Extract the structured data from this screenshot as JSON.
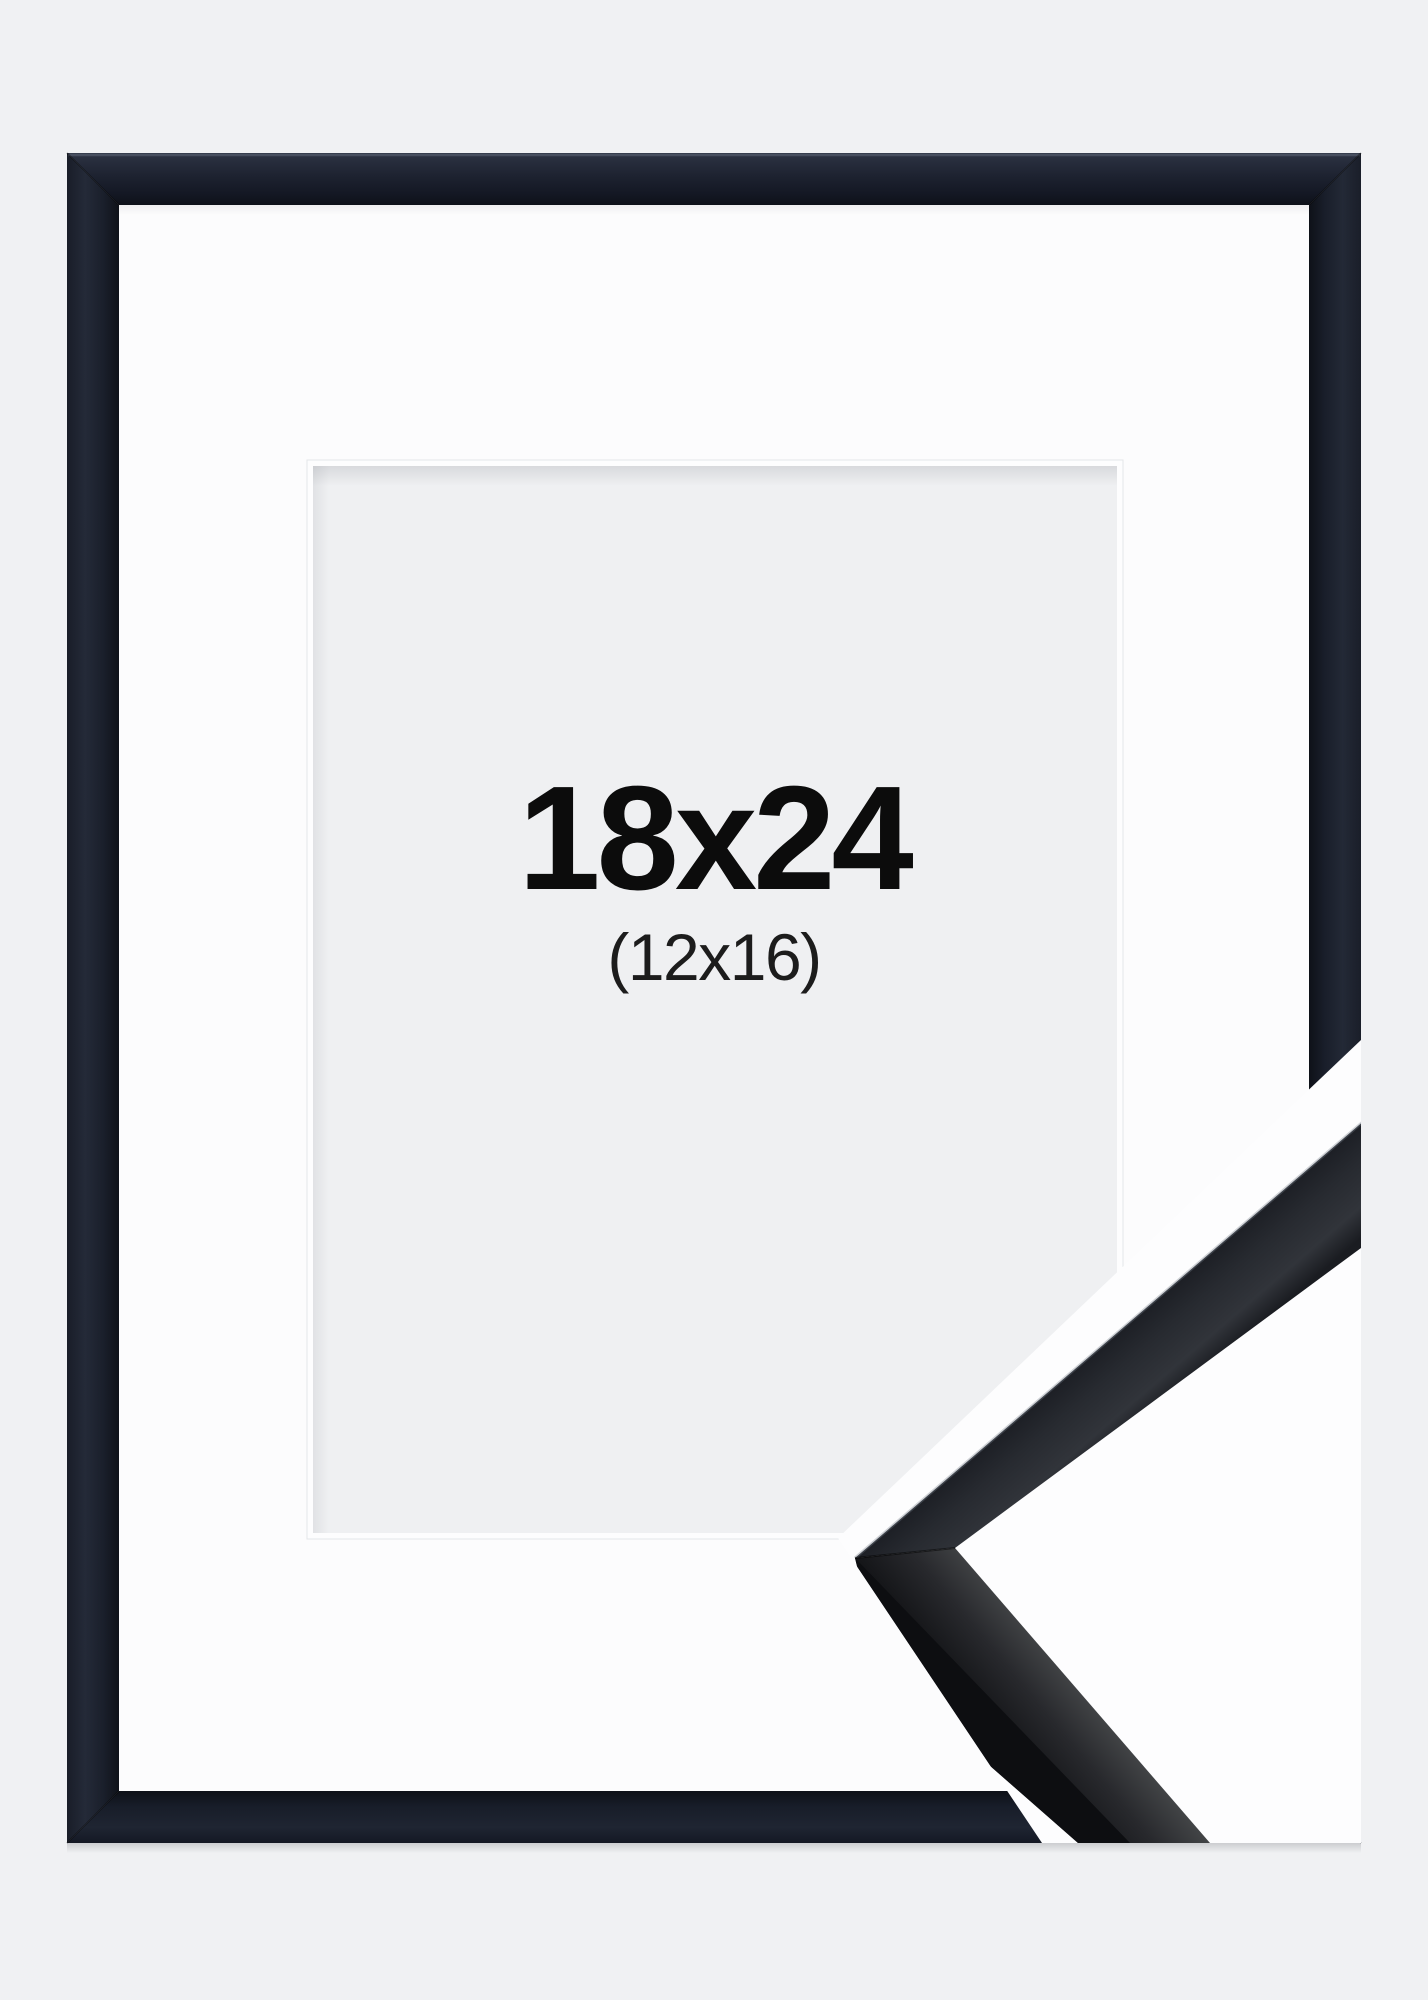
{
  "product": {
    "size_label": "18x24",
    "inner_size_label": "(12x16)"
  },
  "colors": {
    "background": "#f0f1f3",
    "frame_black": "#1b202b",
    "mat_white": "#fcfcfd",
    "bevel_white": "#fdfdfe",
    "opening_gray": "#eff0f2",
    "label_primary": "#0c0c0c",
    "label_secondary": "#1c1c1c",
    "overlay_white": "#fdfdfe",
    "sample_black": "#17181b"
  }
}
